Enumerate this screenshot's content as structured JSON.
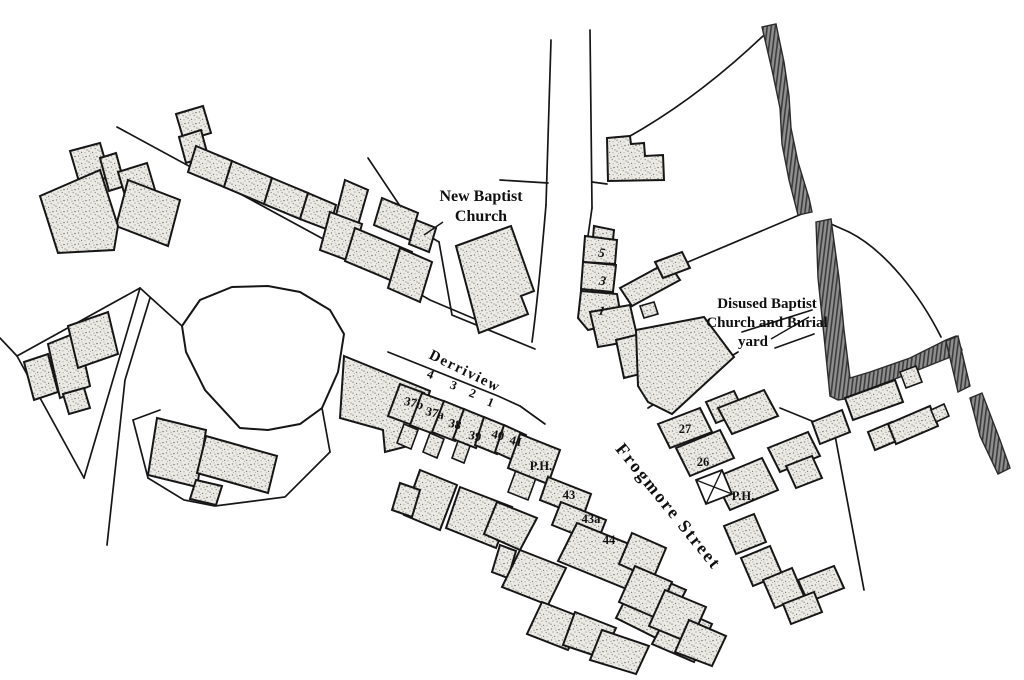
{
  "map": {
    "colors": {
      "background": "#ffffff",
      "line": "#161616",
      "building_base": "#eceae5",
      "building_speckle": "#8d8c85",
      "stream_band": "#8f8f8f",
      "stream_hatch": "#3c3c3c"
    },
    "title_labels": {
      "new_baptist_church": {
        "line1": "New Baptist",
        "line2": "Church"
      },
      "disused_baptist": {
        "line1": "Disused Baptist",
        "line2": "Church and Burial",
        "line3": "yard"
      }
    },
    "street_labels": {
      "derriview": "Derriview",
      "frogmore": "Frogmore Street"
    },
    "plot_numbers": {
      "p4": "4",
      "p3": "3",
      "p2": "2",
      "p1": "1"
    },
    "house_numbers": {
      "n37b": "37b",
      "n37a": "37a",
      "n38": "38",
      "n39": "39",
      "n40": "40",
      "n41": "41",
      "ph_west": "P.H.",
      "n43": "43",
      "n43a": "43a",
      "n44": "44",
      "n5": "5",
      "n3": "3",
      "n1": "1",
      "n27": "27",
      "n26": "26",
      "ph_east": "P.H."
    }
  }
}
